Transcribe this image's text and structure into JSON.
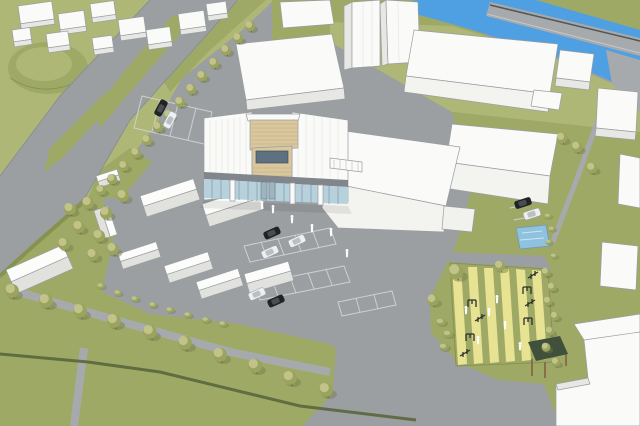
{
  "title": "Aerial 3D architectural massing rendering of a riverside development site",
  "canvas": {
    "width": 640,
    "height": 426
  },
  "colors": {
    "road": "#9b9fa2",
    "road-light": "#a7aaac",
    "mark": "#cdd0d2",
    "grass": "#9fa966",
    "grass-light": "#aeb775",
    "grass-dark": "#87924f",
    "river": "#4f9fe3",
    "pond": "#8fc2de",
    "bldg-top": "#fafaf8",
    "bldg-side": "#e7e8e4",
    "bldg-shade": "#d5d6d2",
    "bldg-front": "#f3f3f0",
    "outline": "#989ea2",
    "wood": "#dbc79d",
    "wood-dark": "#c0a97e",
    "glass": "#b7d1dc",
    "glass-dark": "#5d7180",
    "band": "#80868b",
    "tree": "#9aa45e",
    "tree-light": "#c8c991",
    "tree-shadow": "#707b47",
    "car-black": "#202325",
    "car-white": "#edeff0",
    "py": "#e7e393",
    "hedge": "#59663d",
    "gazebo-roof": "#41503b",
    "gazebo-post": "#8b6c4b",
    "person": "#ffffff",
    "equip": "#2d302c",
    "rail": "#53575a"
  },
  "scene": {
    "setting": {
      "label": "Aerial axonometric rendering of an urban riverside campus, SketchUp-style white massing with landscaped grounds"
    },
    "river": {
      "label": "Blue river running along the top-right with grassed banks"
    },
    "bridge": {
      "label": "Road bridge crossing above the river, top-right corner"
    },
    "roads": {
      "label": "Wide tree-lined access road sweeping from top edge to lower-left"
    },
    "main_building": {
      "label": "Proposed two-storey building with timber-clad core and rooftop volume, glazed ground floor, white panel facades and entrance canopy"
    },
    "massing_hall": {
      "label": "Large white massing hall attached to the east side of the main building"
    },
    "houses": {
      "label": "Cluster of white pitched-roof buildings south-west of the main building",
      "count": 9
    },
    "massing_blocks": {
      "label": "Background context buildings shown as plain white blocks",
      "count": 22
    },
    "parking": {
      "label": "Surface car parks with white-lined stalls (central, north-west and east lots)",
      "car_count": 9
    },
    "playground": {
      "label": "Outdoor gym / play area with pale-yellow striped safety surfacing and exercise equipment",
      "equipment_count": 8
    },
    "gazebo": {
      "label": "Small timber shelter with dark green roof at the south end of the play area"
    },
    "pond": {
      "label": "Small rectangular water feature beside the east car park"
    },
    "landscape": {
      "label": "Lawns, terraced grass mound, hedge lines, shrub beds and tree rows along footpaths",
      "tree_count": 46,
      "shrub_count": 15
    },
    "people": {
      "label": "White pedestrian figures near the entrance plaza and play area",
      "count": 12
    }
  }
}
